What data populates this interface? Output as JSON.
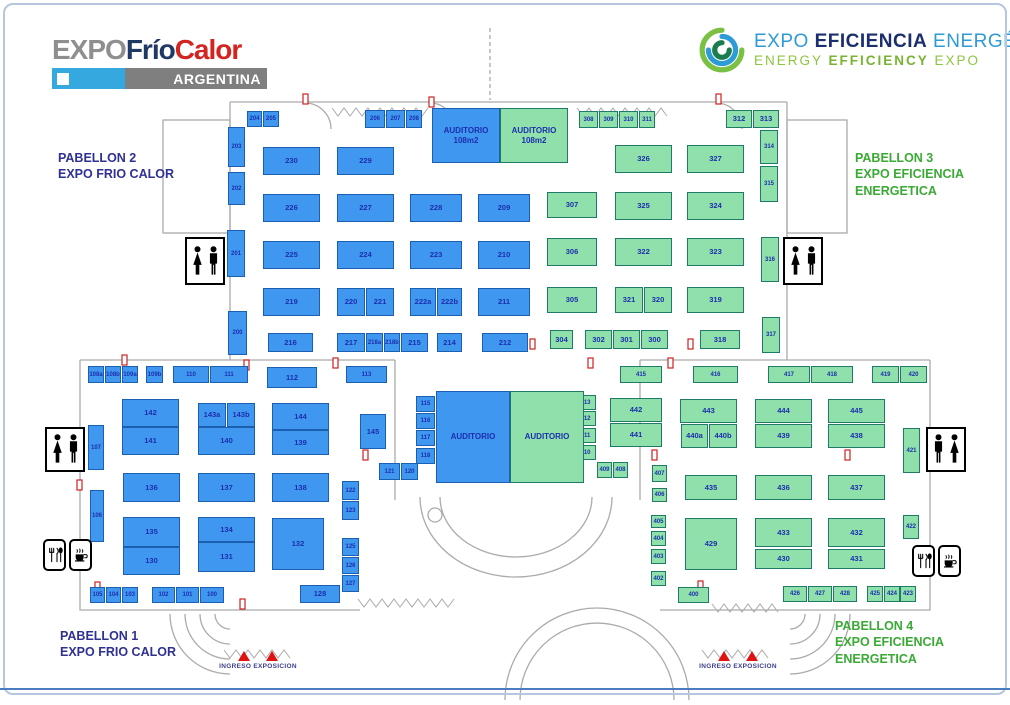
{
  "logos": {
    "frio_calor": {
      "expo": "EXPO",
      "frio": "Frío",
      "calor": "Calor",
      "country": "ARGENTINA"
    },
    "eficiencia": {
      "w1": "EXPO ",
      "w2": "EFICIENCIA",
      "w3": " ENERGÉTICA",
      "line2_a": "ENERGY ",
      "line2_b": "EFFICIENCY",
      "line2_c": " EXPO"
    }
  },
  "pavilion_labels": {
    "p2": {
      "line1": "PABELLON 2",
      "line2": "EXPO  FRIO CALOR",
      "line3": ""
    },
    "p3": {
      "line1": "PABELLON 3",
      "line2": "EXPO EFICIENCIA",
      "line3": "ENERGETICA"
    },
    "p1": {
      "line1": "PABELLON 1",
      "line2": "EXPO  FRIO CALOR",
      "line3": ""
    },
    "p4": {
      "line1": "PABELLON 4",
      "line2": "EXPO EFICIENCIA",
      "line3": "ENERGETICA"
    }
  },
  "entrances": {
    "left": "INGRESO EXPOSICION",
    "right": "INGRESO EXPOSICION"
  },
  "icons": {
    "restroom": "woman-man-silhouette",
    "food": "cutlery-and-coffee-cup",
    "entrance_marker": "red-triangle"
  },
  "colors": {
    "booth_blue": "#3f97f0",
    "booth_blue_border": "#1a5fb0",
    "booth_green": "#8fe0ab",
    "booth_green_border": "#1f7a68",
    "booth_text": "#1c2fae",
    "label_blue": "#2e3192",
    "label_green": "#3aaa35",
    "entrance_red": "#e01212",
    "wall_gray": "#ababab"
  },
  "auditoriums": [
    {
      "label": "AUDITORIO",
      "sub": "108m2",
      "x": 432,
      "y": 108,
      "w": 68,
      "h": 55,
      "c": "b"
    },
    {
      "label": "AUDITORIO",
      "sub": "108m2",
      "x": 500,
      "y": 108,
      "w": 68,
      "h": 55,
      "c": "g"
    },
    {
      "label": "AUDITORIO",
      "sub": "",
      "x": 436,
      "y": 391,
      "w": 74,
      "h": 92,
      "c": "b"
    },
    {
      "label": "AUDITORIO",
      "sub": "",
      "x": 510,
      "y": 391,
      "w": 74,
      "h": 92,
      "c": "g"
    }
  ],
  "booths": [
    [
      "204",
      247,
      111,
      15,
      16,
      "b"
    ],
    [
      "205",
      263,
      111,
      16,
      16,
      "b"
    ],
    [
      "206",
      365,
      110,
      20,
      18,
      "b"
    ],
    [
      "207",
      386,
      110,
      19,
      18,
      "b"
    ],
    [
      "208",
      406,
      110,
      16,
      18,
      "b"
    ],
    [
      "203",
      228,
      127,
      17,
      40,
      "b"
    ],
    [
      "202",
      228,
      172,
      17,
      33,
      "b"
    ],
    [
      "201",
      227,
      230,
      18,
      47,
      "b"
    ],
    [
      "200",
      228,
      311,
      19,
      44,
      "b"
    ],
    [
      "230",
      263,
      147,
      57,
      28,
      "b"
    ],
    [
      "229",
      337,
      147,
      57,
      28,
      "b"
    ],
    [
      "226",
      263,
      194,
      57,
      28,
      "b"
    ],
    [
      "227",
      337,
      194,
      57,
      28,
      "b"
    ],
    [
      "228",
      410,
      194,
      52,
      28,
      "b"
    ],
    [
      "209",
      478,
      194,
      52,
      28,
      "b"
    ],
    [
      "225",
      263,
      241,
      57,
      28,
      "b"
    ],
    [
      "224",
      337,
      241,
      57,
      28,
      "b"
    ],
    [
      "223",
      410,
      241,
      52,
      28,
      "b"
    ],
    [
      "210",
      478,
      241,
      52,
      28,
      "b"
    ],
    [
      "219",
      263,
      288,
      57,
      28,
      "b"
    ],
    [
      "220",
      337,
      288,
      28,
      28,
      "b"
    ],
    [
      "221",
      366,
      288,
      28,
      28,
      "b"
    ],
    [
      "222a",
      410,
      288,
      26,
      28,
      "b"
    ],
    [
      "222b",
      437,
      288,
      25,
      28,
      "b"
    ],
    [
      "211",
      478,
      288,
      52,
      28,
      "b"
    ],
    [
      "216",
      268,
      333,
      45,
      19,
      "b"
    ],
    [
      "217",
      337,
      333,
      28,
      19,
      "b"
    ],
    [
      "218a",
      366,
      333,
      17,
      19,
      "b"
    ],
    [
      "218b",
      384,
      333,
      16,
      19,
      "b"
    ],
    [
      "215",
      401,
      333,
      27,
      19,
      "b"
    ],
    [
      "214",
      437,
      333,
      25,
      19,
      "b"
    ],
    [
      "212",
      482,
      333,
      46,
      19,
      "b"
    ],
    [
      "308",
      579,
      111,
      19,
      17,
      "g"
    ],
    [
      "309",
      599,
      111,
      19,
      17,
      "g"
    ],
    [
      "310",
      619,
      111,
      19,
      17,
      "g"
    ],
    [
      "311",
      639,
      111,
      16,
      17,
      "g"
    ],
    [
      "312",
      726,
      110,
      26,
      18,
      "g"
    ],
    [
      "313",
      753,
      110,
      26,
      18,
      "g"
    ],
    [
      "314",
      760,
      130,
      18,
      34,
      "g"
    ],
    [
      "315",
      760,
      166,
      18,
      36,
      "g"
    ],
    [
      "316",
      761,
      237,
      18,
      45,
      "g"
    ],
    [
      "317",
      762,
      317,
      18,
      36,
      "g"
    ],
    [
      "326",
      615,
      145,
      57,
      28,
      "g"
    ],
    [
      "327",
      687,
      145,
      57,
      28,
      "g"
    ],
    [
      "307",
      547,
      192,
      50,
      26,
      "g"
    ],
    [
      "325",
      615,
      192,
      57,
      28,
      "g"
    ],
    [
      "324",
      687,
      192,
      57,
      28,
      "g"
    ],
    [
      "306",
      547,
      238,
      50,
      28,
      "g"
    ],
    [
      "322",
      615,
      238,
      57,
      28,
      "g"
    ],
    [
      "323",
      687,
      238,
      57,
      28,
      "g"
    ],
    [
      "305",
      547,
      287,
      50,
      26,
      "g"
    ],
    [
      "321",
      615,
      287,
      28,
      26,
      "g"
    ],
    [
      "320",
      644,
      287,
      28,
      26,
      "g"
    ],
    [
      "319",
      687,
      287,
      57,
      26,
      "g"
    ],
    [
      "304",
      550,
      330,
      23,
      19,
      "g"
    ],
    [
      "302",
      585,
      330,
      27,
      19,
      "g"
    ],
    [
      "301",
      613,
      330,
      27,
      19,
      "g"
    ],
    [
      "300",
      641,
      330,
      27,
      19,
      "g"
    ],
    [
      "318",
      700,
      330,
      40,
      19,
      "g"
    ],
    [
      "113",
      346,
      366,
      41,
      17,
      "b"
    ],
    [
      "145",
      360,
      414,
      26,
      35,
      "b"
    ],
    [
      "115",
      416,
      396,
      19,
      16,
      "b"
    ],
    [
      "116",
      416,
      413,
      19,
      16,
      "b"
    ],
    [
      "117",
      416,
      430,
      19,
      16,
      "b"
    ],
    [
      "118",
      416,
      448,
      19,
      16,
      "b"
    ],
    [
      "121",
      379,
      463,
      21,
      17,
      "b"
    ],
    [
      "120",
      401,
      463,
      17,
      17,
      "b"
    ],
    [
      "413",
      575,
      395,
      21,
      15,
      "g"
    ],
    [
      "412",
      575,
      411,
      21,
      15,
      "g"
    ],
    [
      "411",
      575,
      428,
      21,
      15,
      "g"
    ],
    [
      "410",
      575,
      445,
      21,
      15,
      "g"
    ],
    [
      "409",
      597,
      462,
      15,
      16,
      "g"
    ],
    [
      "408",
      613,
      462,
      15,
      16,
      "g"
    ],
    [
      "108a",
      88,
      366,
      16,
      17,
      "b"
    ],
    [
      "108b",
      105,
      366,
      16,
      17,
      "b"
    ],
    [
      "109a",
      122,
      366,
      16,
      17,
      "b"
    ],
    [
      "109b",
      146,
      366,
      17,
      17,
      "b"
    ],
    [
      "110",
      173,
      366,
      36,
      17,
      "b"
    ],
    [
      "111",
      210,
      366,
      38,
      17,
      "b"
    ],
    [
      "112",
      267,
      367,
      50,
      21,
      "b"
    ],
    [
      "142",
      122,
      399,
      57,
      28,
      "b"
    ],
    [
      "141",
      122,
      427,
      57,
      28,
      "b"
    ],
    [
      "143a",
      198,
      403,
      28,
      24,
      "b"
    ],
    [
      "143b",
      227,
      403,
      28,
      24,
      "b"
    ],
    [
      "140",
      198,
      427,
      57,
      28,
      "b"
    ],
    [
      "144",
      272,
      403,
      57,
      27,
      "b"
    ],
    [
      "139",
      272,
      430,
      57,
      25,
      "b"
    ],
    [
      "107",
      88,
      425,
      16,
      45,
      "b"
    ],
    [
      "106",
      90,
      490,
      14,
      52,
      "b"
    ],
    [
      "136",
      123,
      473,
      57,
      29,
      "b"
    ],
    [
      "137",
      198,
      473,
      57,
      29,
      "b"
    ],
    [
      "138",
      272,
      473,
      57,
      29,
      "b"
    ],
    [
      "135",
      123,
      517,
      57,
      30,
      "b"
    ],
    [
      "130",
      123,
      547,
      57,
      28,
      "b"
    ],
    [
      "134",
      198,
      517,
      57,
      25,
      "b"
    ],
    [
      "131",
      198,
      542,
      57,
      30,
      "b"
    ],
    [
      "132",
      272,
      518,
      52,
      52,
      "b"
    ],
    [
      "105",
      90,
      587,
      15,
      16,
      "b"
    ],
    [
      "104",
      106,
      587,
      15,
      16,
      "b"
    ],
    [
      "103",
      122,
      587,
      16,
      16,
      "b"
    ],
    [
      "102",
      152,
      587,
      23,
      16,
      "b"
    ],
    [
      "101",
      176,
      587,
      23,
      16,
      "b"
    ],
    [
      "100",
      200,
      587,
      24,
      16,
      "b"
    ],
    [
      "128",
      300,
      585,
      40,
      18,
      "b"
    ],
    [
      "122",
      342,
      481,
      17,
      19,
      "b"
    ],
    [
      "123",
      342,
      501,
      17,
      19,
      "b"
    ],
    [
      "125",
      342,
      538,
      17,
      18,
      "b"
    ],
    [
      "126",
      342,
      557,
      17,
      17,
      "b"
    ],
    [
      "127",
      342,
      575,
      17,
      17,
      "b"
    ],
    [
      "415",
      620,
      366,
      42,
      17,
      "g"
    ],
    [
      "416",
      693,
      366,
      45,
      17,
      "g"
    ],
    [
      "417",
      768,
      366,
      42,
      17,
      "g"
    ],
    [
      "418",
      811,
      366,
      42,
      17,
      "g"
    ],
    [
      "419",
      872,
      366,
      27,
      17,
      "g"
    ],
    [
      "420",
      900,
      366,
      27,
      17,
      "g"
    ],
    [
      "442",
      610,
      398,
      52,
      24,
      "g"
    ],
    [
      "441",
      610,
      423,
      52,
      24,
      "g"
    ],
    [
      "443",
      680,
      399,
      57,
      24,
      "g"
    ],
    [
      "440a",
      681,
      424,
      27,
      24,
      "g"
    ],
    [
      "440b",
      709,
      424,
      28,
      24,
      "g"
    ],
    [
      "444",
      755,
      399,
      57,
      24,
      "g"
    ],
    [
      "439",
      755,
      424,
      57,
      24,
      "g"
    ],
    [
      "445",
      828,
      399,
      57,
      24,
      "g"
    ],
    [
      "438",
      828,
      424,
      57,
      24,
      "g"
    ],
    [
      "421",
      903,
      428,
      17,
      45,
      "g"
    ],
    [
      "422",
      903,
      515,
      16,
      24,
      "g"
    ],
    [
      "407",
      652,
      465,
      15,
      17,
      "g"
    ],
    [
      "406",
      652,
      488,
      15,
      14,
      "g"
    ],
    [
      "405",
      651,
      515,
      15,
      13,
      "g"
    ],
    [
      "404",
      651,
      531,
      15,
      15,
      "g"
    ],
    [
      "403",
      651,
      549,
      15,
      15,
      "g"
    ],
    [
      "402",
      651,
      571,
      15,
      15,
      "g"
    ],
    [
      "400",
      678,
      587,
      31,
      16,
      "g"
    ],
    [
      "435",
      685,
      475,
      52,
      25,
      "g"
    ],
    [
      "436",
      755,
      475,
      57,
      25,
      "g"
    ],
    [
      "437",
      828,
      475,
      57,
      25,
      "g"
    ],
    [
      "429",
      685,
      518,
      52,
      52,
      "g"
    ],
    [
      "433",
      755,
      518,
      57,
      29,
      "g"
    ],
    [
      "430",
      755,
      549,
      57,
      20,
      "g"
    ],
    [
      "432",
      828,
      518,
      57,
      29,
      "g"
    ],
    [
      "431",
      828,
      549,
      57,
      20,
      "g"
    ],
    [
      "426",
      783,
      586,
      24,
      16,
      "g"
    ],
    [
      "427",
      808,
      586,
      24,
      16,
      "g"
    ],
    [
      "428",
      833,
      586,
      24,
      16,
      "g"
    ],
    [
      "425",
      867,
      586,
      16,
      16,
      "g"
    ],
    [
      "424",
      884,
      586,
      16,
      16,
      "g"
    ],
    [
      "423",
      900,
      586,
      16,
      16,
      "g"
    ]
  ]
}
